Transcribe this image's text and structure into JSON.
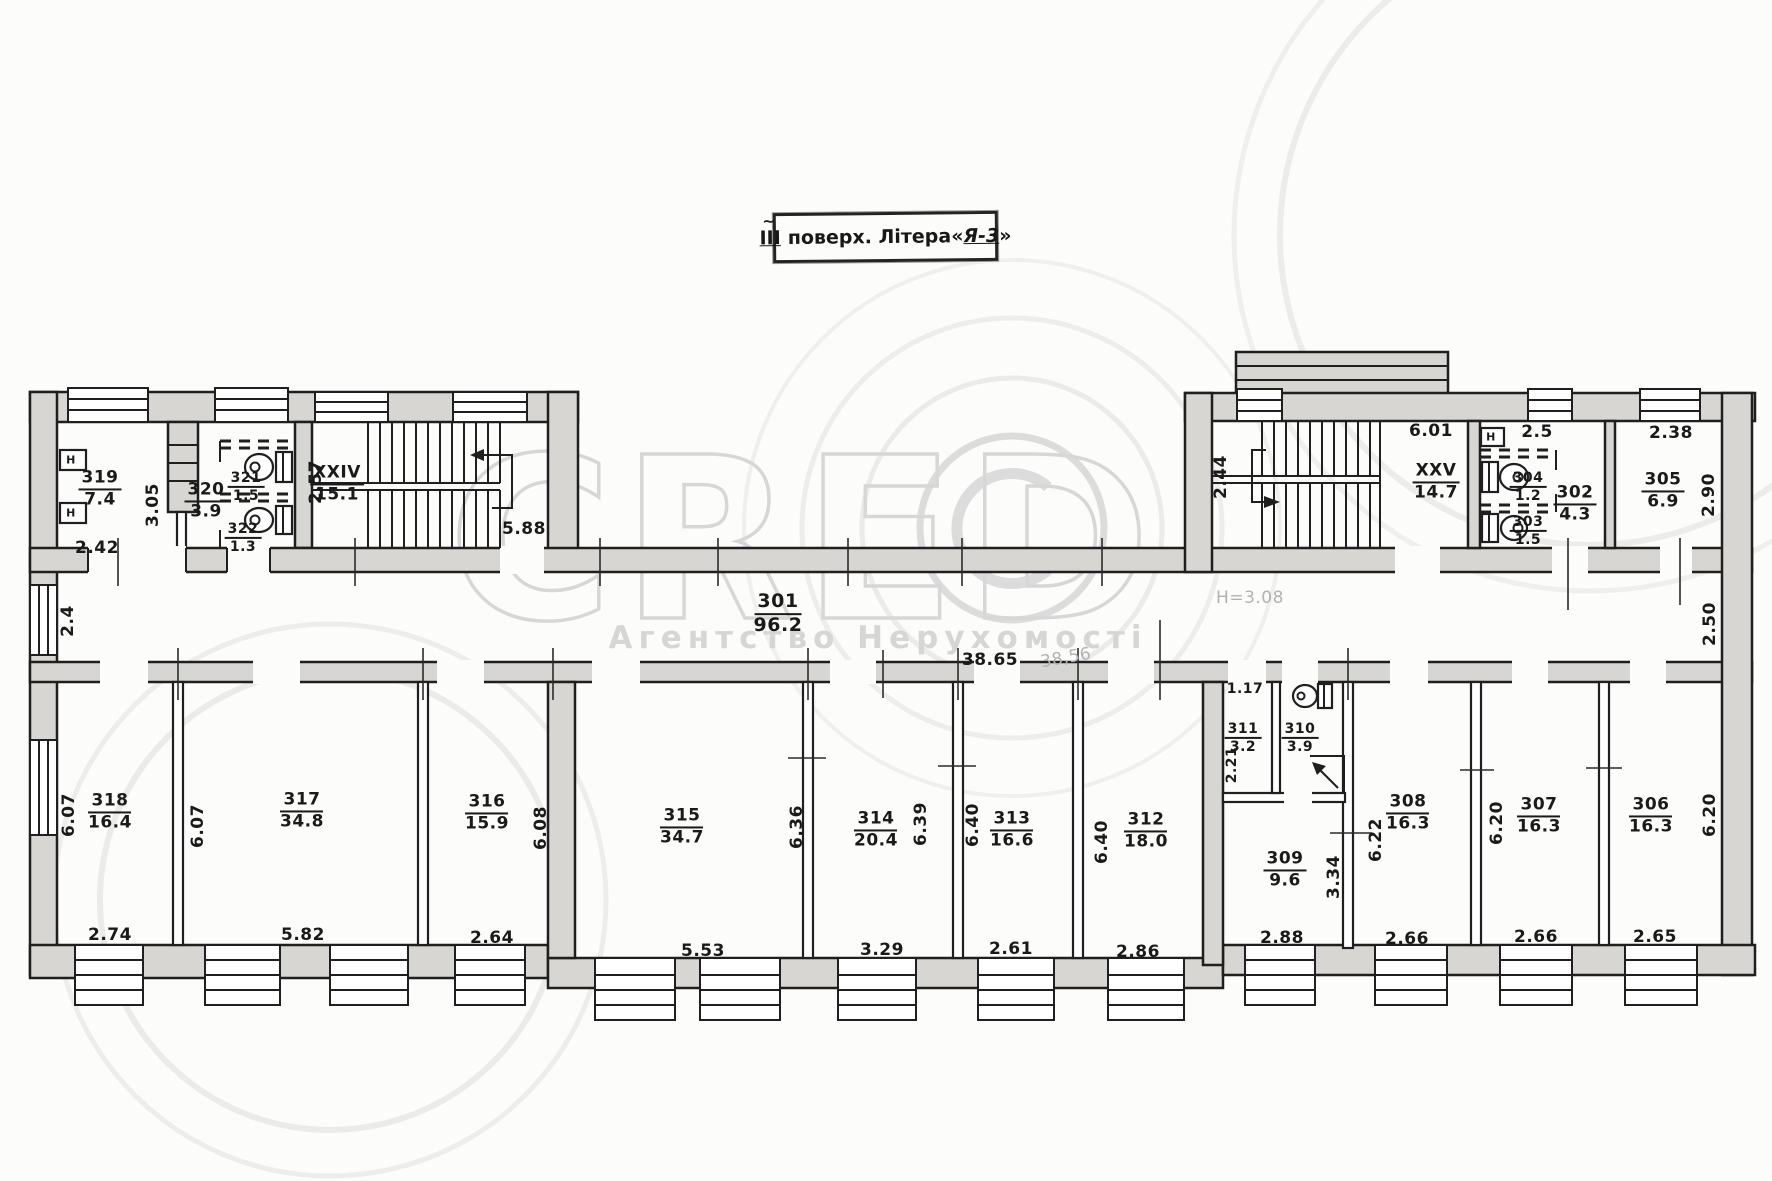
{
  "title": {
    "floor": "ІІІ",
    "tilde": "~",
    "text": "поверх. Літера",
    "open_quote": "«",
    "letter": "Я-3",
    "close_quote": "»"
  },
  "watermark": {
    "brand": "CRED",
    "subtitle": "Агентство Нерухомості"
  },
  "symbols": {
    "h_niche": "Н"
  },
  "rooms": {
    "301": {
      "number": "301",
      "area": "96.2"
    },
    "302": {
      "number": "302",
      "area": "4.3"
    },
    "303": {
      "number": "303",
      "area": "1.5"
    },
    "304": {
      "number": "304",
      "area": "1.2"
    },
    "305": {
      "number": "305",
      "area": "6.9"
    },
    "306": {
      "number": "306",
      "area": "16.3"
    },
    "307": {
      "number": "307",
      "area": "16.3"
    },
    "308": {
      "number": "308",
      "area": "16.3"
    },
    "309": {
      "number": "309",
      "area": "9.6"
    },
    "310": {
      "number": "310",
      "area": "3.9"
    },
    "311": {
      "number": "311",
      "area": "3.2"
    },
    "312": {
      "number": "312",
      "area": "18.0"
    },
    "313": {
      "number": "313",
      "area": "16.6"
    },
    "314": {
      "number": "314",
      "area": "20.4"
    },
    "315": {
      "number": "315",
      "area": "34.7"
    },
    "316": {
      "number": "316",
      "area": "15.9"
    },
    "317": {
      "number": "317",
      "area": "34.8"
    },
    "318": {
      "number": "318",
      "area": "16.4"
    },
    "319": {
      "number": "319",
      "area": "7.4"
    },
    "320": {
      "number": "320",
      "area": "3.9"
    },
    "321": {
      "number": "321",
      "area": "1.5"
    },
    "322": {
      "number": "322",
      "area": "1.3"
    }
  },
  "stairs": {
    "xxiv": {
      "name": "XXIV",
      "area": "15.1"
    },
    "xxv": {
      "name": "XXV",
      "area": "14.7"
    }
  },
  "notes": {
    "height": "H=3.08",
    "pencil_length": "38,56"
  },
  "dims": {
    "corridor_length": "38.65",
    "corridor_left_width": "2.4",
    "corridor_right_width": "2.50",
    "r319_opening": "2.42",
    "shaft_319": "3.05",
    "stair24_depth": "2.57",
    "stair24_width": "5.88",
    "stair25_landing": "2.44",
    "stair25_hall": "6.01",
    "r302_top": "2.5",
    "r305_top": "2.38",
    "r305_right": "2.90",
    "r318_left": "6.07",
    "r318_bottom": "2.74",
    "r317_left": "6.07",
    "r317_bottom": "5.82",
    "r316_right": "6.08",
    "r316_bottom": "2.64",
    "r315_bottom": "5.53",
    "r314_left": "6.36",
    "r314_right": "6.39",
    "r314_bottom": "3.29",
    "r313_left": "6.40",
    "r313_bottom": "2.61",
    "r312_left": "6.40",
    "r312_bottom": "2.86",
    "r311_top": "1.17",
    "r311_left": "2.21",
    "r309_bottom": "2.88",
    "r309_right": "3.34",
    "r308_left": "6.22",
    "r308_bottom": "2.66",
    "r307_left": "6.20",
    "r307_bottom": "2.66",
    "r306_right": "6.20",
    "r306_bottom": "2.65"
  }
}
